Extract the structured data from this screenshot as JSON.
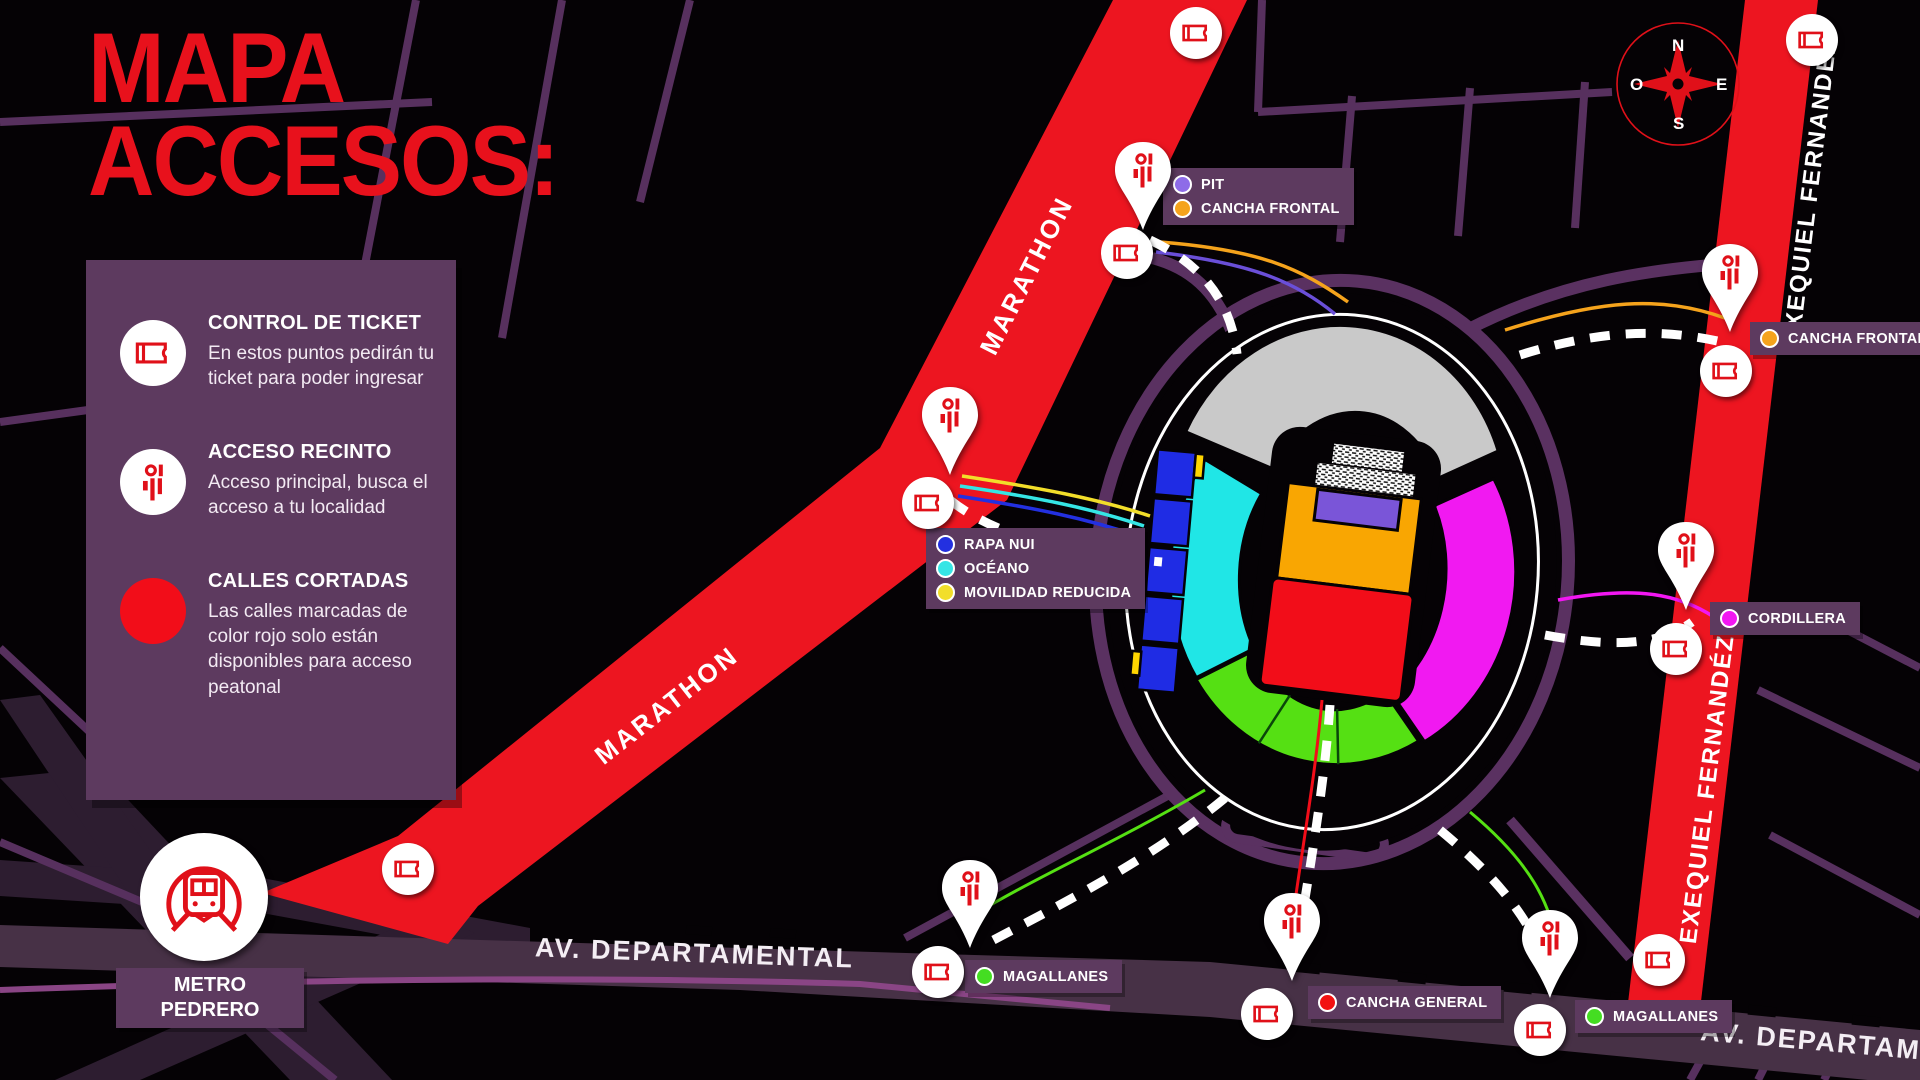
{
  "title": {
    "line1": "MAPA",
    "line2": "ACCESOS:"
  },
  "legend": {
    "control": {
      "title": "CONTROL DE TICKET",
      "body": "En estos puntos pedirán tu ticket para poder ingresar"
    },
    "acceso": {
      "title": "ACCESO RECINTO",
      "body": "Acceso principal, busca el acceso a tu localidad"
    },
    "calles": {
      "title": "CALLES CORTADAS",
      "body": "Las calles marcadas de color rojo solo están disponibles para acceso peatonal"
    }
  },
  "streets": {
    "marathon": "MARATHON",
    "departamental": "AV. DEPARTAMENTAL",
    "exequiel": "EXEQUIEL FERNANDÉZ"
  },
  "metro": {
    "line1": "METRO",
    "line2": "PEDRERO"
  },
  "compass": {
    "n": "N",
    "s": "S",
    "e": "E",
    "o": "O"
  },
  "labels": {
    "pit_frontal": {
      "rows": [
        {
          "text": "PIT",
          "color": "#8e6ce8"
        },
        {
          "text": "CANCHA FRONTAL",
          "color": "#f5a31c"
        }
      ]
    },
    "frontal_right": {
      "rows": [
        {
          "text": "CANCHA FRONTAL",
          "color": "#f5a31c"
        }
      ]
    },
    "rapa_oceano": {
      "rows": [
        {
          "text": "RAPA NUI",
          "color": "#2330e0"
        },
        {
          "text": "OCÉANO",
          "color": "#35e5e5"
        },
        {
          "text": "MOVILIDAD REDUCIDA",
          "color": "#f2de2a"
        }
      ]
    },
    "cordillera": {
      "rows": [
        {
          "text": "CORDILLERA",
          "color": "#f217f2"
        }
      ]
    },
    "magallanes_left": {
      "rows": [
        {
          "text": "MAGALLANES",
          "color": "#44dd22"
        }
      ]
    },
    "cancha_general": {
      "rows": [
        {
          "text": "CANCHA GENERAL",
          "color": "#f21111"
        }
      ]
    },
    "magallanes_right": {
      "rows": [
        {
          "text": "MAGALLANES",
          "color": "#44dd22"
        }
      ]
    }
  },
  "zones": {
    "tribuna_gray": "#c9c9c9",
    "oceano": "#20e6e6",
    "cordillera": "#f119f1",
    "magallanes": "#55e013",
    "rapa_nui": "#1f2ce4",
    "movilidad_reducida": "#ffd500",
    "cancha_frontal": "#f9a602",
    "pit": "#7a55d8",
    "cancha_general": "#f20d19"
  },
  "map_colors": {
    "closed_road_red": "#ed1520",
    "street_purple": "#57305e",
    "panel_purple": "#5d3a5f",
    "departamental_band": "#473146"
  }
}
